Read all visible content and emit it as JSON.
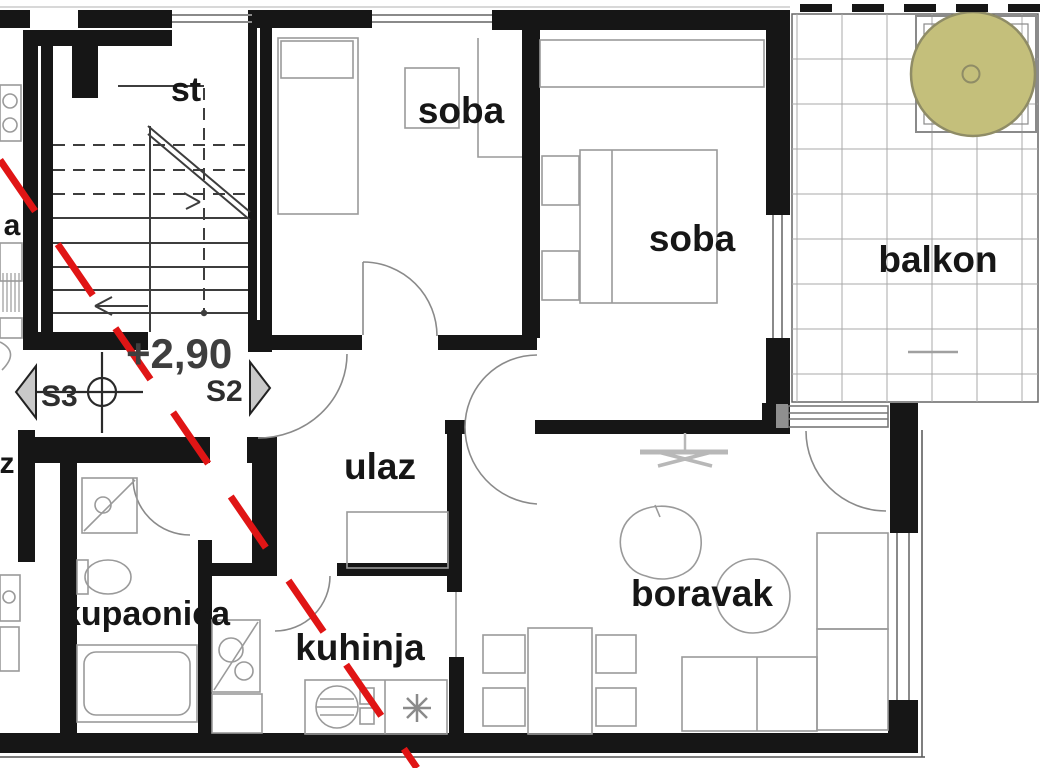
{
  "document": {
    "type": "apartment-floor-plan",
    "language": "Croatian"
  },
  "rooms": {
    "stairwell": {
      "label": "st"
    },
    "bedroom_1": {
      "label": "soba"
    },
    "bedroom_2": {
      "label": "soba"
    },
    "balcony": {
      "label": "balkon"
    },
    "entrance_hall": {
      "label": "ulaz"
    },
    "bathroom": {
      "label": "kupaonica"
    },
    "kitchen": {
      "label": "kuhinja"
    },
    "living_room": {
      "label": "boravak"
    }
  },
  "markers": {
    "elevation": "+2,90",
    "section_left": "S3",
    "section_right": "S2"
  },
  "adjacent_unit": {
    "partial_label_upper": "a",
    "partial_label_lower": "z"
  },
  "colors": {
    "wall": "#161616",
    "furniture_outline": "#9a9a9a",
    "window_line": "#8a8a8a",
    "section_line_red": "#e01515",
    "tree_fill": "#c4bf7b",
    "tree_stroke": "#8f8c66",
    "marker_triangle_fill": "#c9c9c9",
    "balcony_grid": "#a8a8a8",
    "text": "#161616"
  }
}
